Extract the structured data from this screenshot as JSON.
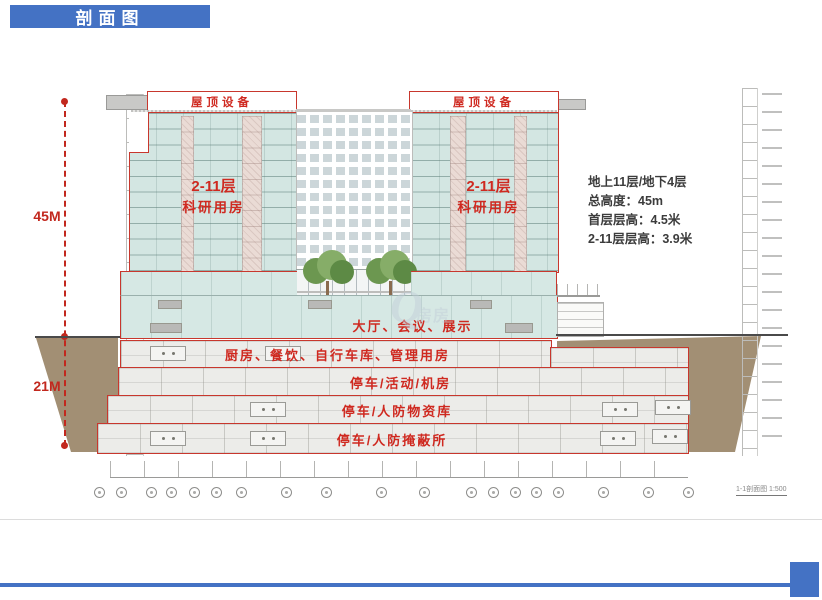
{
  "slide": {
    "title": "剖面图"
  },
  "info_panel": {
    "lines": [
      "地上11层/地下4层",
      "总高度：45m",
      "首层层高：4.5米",
      "2-11层层高：3.9米"
    ]
  },
  "dimensions": {
    "above_ground": "45M",
    "below_ground": "21M"
  },
  "section": {
    "roof_left": "屋顶设备",
    "roof_right": "屋顶设备",
    "tower_left_line1": "2-11层",
    "tower_left_line2": "科研用房",
    "tower_right_line1": "2-11层",
    "tower_right_line2": "科研用房",
    "ground_floor": "大厅、会议、展示",
    "basement1": "厨房、餐饮、自行车库、管理用房",
    "basement2": "停车/活动/机房",
    "basement3": "停车/人防物资库",
    "basement4": "停车/人防掩蔽所",
    "scale_note": "1-1剖面图 1:500"
  },
  "watermark": {
    "initial": "Q",
    "text": "房房"
  },
  "colors": {
    "accent_blue": "#4472C4",
    "outline_red": "#C8372D",
    "label_red": "#CF2920",
    "floor_teal": "#D3E6E2",
    "earth_brown": "#A28F74"
  }
}
